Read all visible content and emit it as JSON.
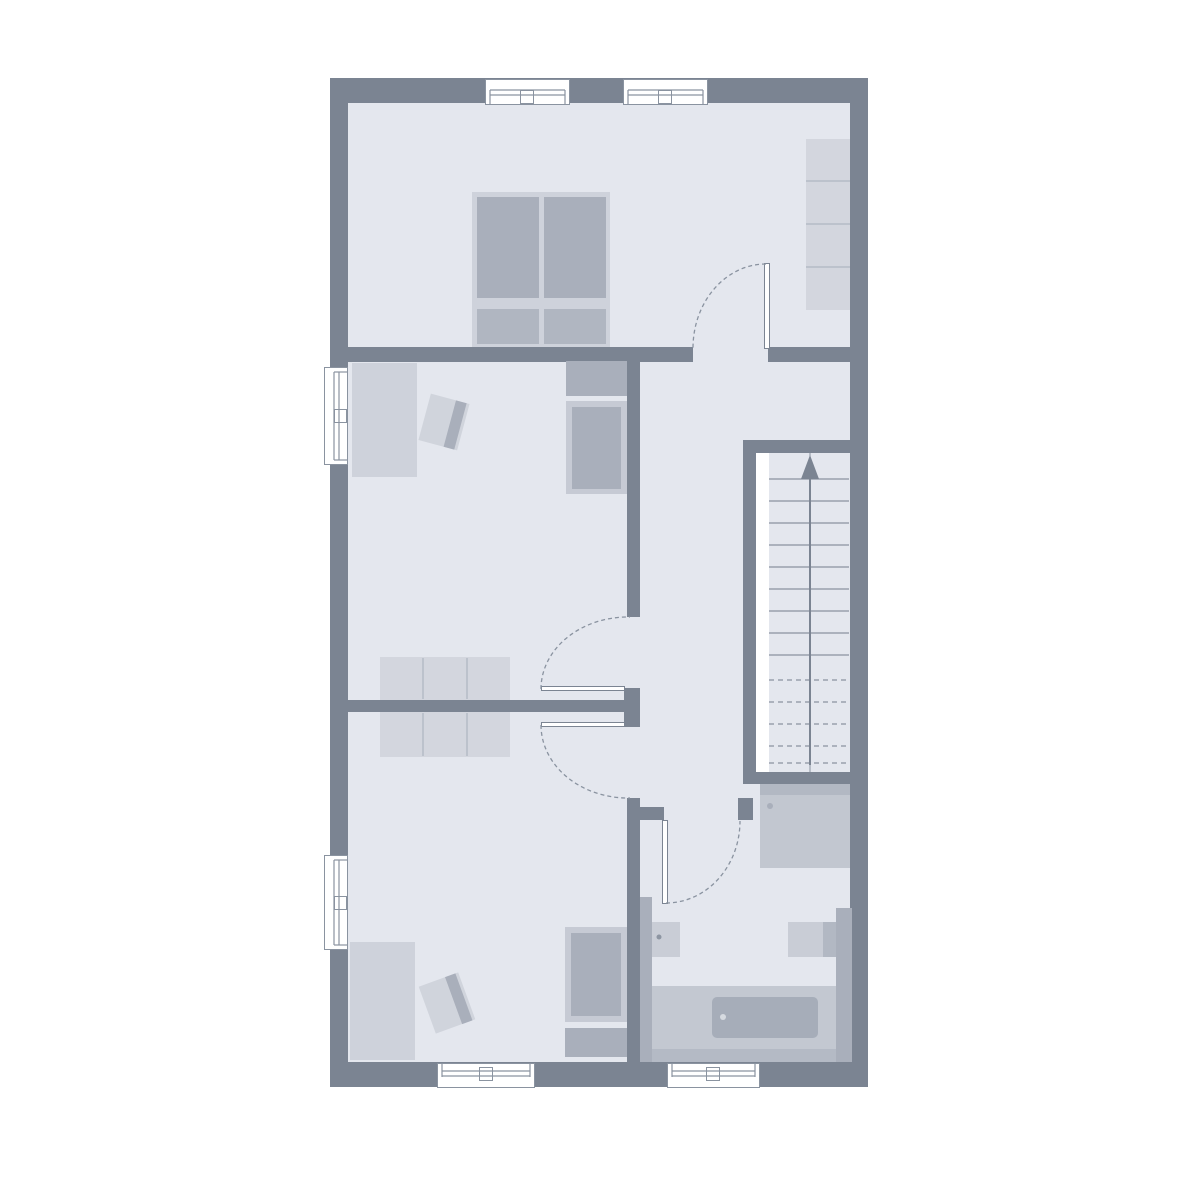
{
  "palette": {
    "bg": "#ffffff",
    "wall": "#7b8492",
    "floor": "#e4e7ee",
    "white": "#ffffff",
    "line": "#8a93a0",
    "furn_light": "#ced2db",
    "furn_light2": "#d3d6de",
    "furn_frame": "#c6cad4",
    "furn_med": "#a9afbb",
    "furn_med2": "#b2b8c3",
    "pillow": "#b0b6c1",
    "shower": "#c2c7d0",
    "basin": "#c9cdd6",
    "surround": "#c3c8d1",
    "tub": "#a6adb9",
    "band": "#b4bac5",
    "chair": "#d0d4dc",
    "divider": "#b5bbc6",
    "dot_light": "#d6dae0",
    "dot_dark": "#8d95a2"
  },
  "stairs": {
    "direction": "up",
    "solid_treads": 9,
    "dashed_treads": 5
  },
  "counts": {
    "windows": 6,
    "door_swings": 4,
    "rooms": 5
  },
  "plan": {
    "width": 1200,
    "height": 1200,
    "rects": [
      {
        "name": "outer-wall",
        "x": 330,
        "y": 78,
        "w": 538,
        "h": 1009,
        "fill": "wall"
      },
      {
        "name": "floor",
        "x": 348,
        "y": 103,
        "w": 502,
        "h": 959,
        "fill": "floor"
      },
      {
        "name": "wall-bedroom-bottom-left",
        "x": 348,
        "y": 347,
        "w": 345,
        "h": 15,
        "fill": "wall"
      },
      {
        "name": "wall-bedroom-bottom-right",
        "x": 768,
        "y": 347,
        "w": 82,
        "h": 15,
        "fill": "wall"
      },
      {
        "name": "wall-hallway-west",
        "x": 627,
        "y": 362,
        "w": 13,
        "h": 255,
        "fill": "wall"
      },
      {
        "name": "wall-center-door-jamb",
        "x": 624,
        "y": 688,
        "w": 16,
        "h": 39,
        "fill": "wall"
      },
      {
        "name": "wall-rooms-divider",
        "x": 348,
        "y": 700,
        "w": 276,
        "h": 12,
        "fill": "wall"
      },
      {
        "name": "wall-bathroom-west",
        "x": 627,
        "y": 798,
        "w": 13,
        "h": 264,
        "fill": "wall"
      },
      {
        "name": "wall-bathroom-door-jamb-left",
        "x": 627,
        "y": 807,
        "w": 37,
        "h": 13,
        "fill": "wall"
      },
      {
        "name": "wall-bathroom-door-jamb-right",
        "x": 738,
        "y": 798,
        "w": 15,
        "h": 22,
        "fill": "wall"
      },
      {
        "name": "wall-stairwell-top",
        "x": 743,
        "y": 440,
        "w": 107,
        "h": 13,
        "fill": "wall"
      },
      {
        "name": "wall-stairwell-left",
        "x": 743,
        "y": 453,
        "w": 13,
        "h": 329,
        "fill": "wall"
      },
      {
        "name": "wall-stairwell-bottom",
        "x": 743,
        "y": 772,
        "w": 107,
        "h": 12,
        "fill": "wall"
      },
      {
        "name": "stair-side-strip",
        "x": 756,
        "y": 453,
        "w": 13,
        "h": 319,
        "fill": "white"
      },
      {
        "name": "double-bed-frame",
        "x": 472,
        "y": 192,
        "w": 138,
        "h": 155,
        "fill": "furn_light"
      },
      {
        "name": "double-bed-mattress-left",
        "x": 477,
        "y": 197,
        "w": 62,
        "h": 101,
        "fill": "furn_med"
      },
      {
        "name": "double-bed-mattress-right",
        "x": 544,
        "y": 197,
        "w": 62,
        "h": 101,
        "fill": "furn_med"
      },
      {
        "name": "double-bed-pillow-left",
        "x": 477,
        "y": 309,
        "w": 62,
        "h": 35,
        "fill": "pillow"
      },
      {
        "name": "double-bed-pillow-right",
        "x": 544,
        "y": 309,
        "w": 62,
        "h": 35,
        "fill": "pillow"
      },
      {
        "name": "wardrobe-shelves",
        "x": 806,
        "y": 139,
        "w": 44,
        "h": 171,
        "fill": "furn_light2"
      },
      {
        "name": "desk-middle-room",
        "x": 352,
        "y": 363,
        "w": 65,
        "h": 114,
        "fill": "furn_light"
      },
      {
        "name": "single-bed-headboard-middle",
        "x": 566,
        "y": 361,
        "w": 61,
        "h": 35,
        "fill": "furn_med"
      },
      {
        "name": "single-bed-frame-middle",
        "x": 566,
        "y": 401,
        "w": 61,
        "h": 93,
        "fill": "furn_frame"
      },
      {
        "name": "single-bed-mattress-middle",
        "x": 572,
        "y": 407,
        "w": 49,
        "h": 82,
        "fill": "furn_med"
      },
      {
        "name": "dresser-middle-room",
        "x": 380,
        "y": 657,
        "w": 130,
        "h": 43,
        "fill": "furn_light2"
      },
      {
        "name": "dresser-bottom-room",
        "x": 380,
        "y": 712,
        "w": 130,
        "h": 45,
        "fill": "furn_light2"
      },
      {
        "name": "desk-bottom-room",
        "x": 350,
        "y": 942,
        "w": 65,
        "h": 118,
        "fill": "furn_light"
      },
      {
        "name": "single-bed-frame-bottom",
        "x": 565,
        "y": 927,
        "w": 62,
        "h": 95,
        "fill": "furn_frame"
      },
      {
        "name": "single-bed-mattress-bottom",
        "x": 571,
        "y": 933,
        "w": 50,
        "h": 83,
        "fill": "furn_med"
      },
      {
        "name": "single-bed-headboard-bottom",
        "x": 565,
        "y": 1028,
        "w": 62,
        "h": 29,
        "fill": "furn_med"
      },
      {
        "name": "chair-middle-room",
        "x": 424,
        "y": 398,
        "w": 40,
        "h": 48,
        "fill": "chair",
        "rotate": 15,
        "band": "furn_med"
      },
      {
        "name": "chair-bottom-room",
        "x": 426,
        "y": 978,
        "w": 42,
        "h": 50,
        "fill": "chair",
        "rotate": -20,
        "band": "furn_med"
      },
      {
        "name": "shower-top-band",
        "x": 760,
        "y": 784,
        "w": 90,
        "h": 11,
        "fill": "furn_med2"
      },
      {
        "name": "shower",
        "x": 760,
        "y": 795,
        "w": 90,
        "h": 73,
        "fill": "shower"
      },
      {
        "name": "bath-ledge-left",
        "x": 640,
        "y": 897,
        "w": 12,
        "h": 165,
        "fill": "furn_med"
      },
      {
        "name": "washbasin-left",
        "x": 652,
        "y": 922,
        "w": 28,
        "h": 35,
        "fill": "basin"
      },
      {
        "name": "washbasin-right",
        "x": 788,
        "y": 922,
        "w": 35,
        "h": 35,
        "fill": "basin"
      },
      {
        "name": "washbasin-right-side",
        "x": 823,
        "y": 922,
        "w": 13,
        "h": 35,
        "fill": "furn_med2"
      },
      {
        "name": "bath-pillar-right",
        "x": 836,
        "y": 908,
        "w": 16,
        "h": 154,
        "fill": "furn_med"
      },
      {
        "name": "bathtub-surround",
        "x": 652,
        "y": 986,
        "w": 184,
        "h": 76,
        "fill": "surround"
      },
      {
        "name": "bath-bottom-band",
        "x": 652,
        "y": 1049,
        "w": 184,
        "h": 13,
        "fill": "band"
      },
      {
        "name": "bathtub",
        "x": 712,
        "y": 997,
        "w": 106,
        "h": 41,
        "fill": "tub",
        "radius": 5
      },
      {
        "name": "window-top-1",
        "x": 485,
        "y": 79,
        "w": 85,
        "h": 26,
        "fill": "white",
        "stroke": "line"
      },
      {
        "name": "window-top-2",
        "x": 623,
        "y": 79,
        "w": 85,
        "h": 26,
        "fill": "white",
        "stroke": "line"
      },
      {
        "name": "window-left-1",
        "x": 324,
        "y": 367,
        "w": 24,
        "h": 98,
        "fill": "white",
        "stroke": "line"
      },
      {
        "name": "window-left-2",
        "x": 324,
        "y": 855,
        "w": 24,
        "h": 95,
        "fill": "white",
        "stroke": "line"
      },
      {
        "name": "window-bottom-1",
        "x": 437,
        "y": 1063,
        "w": 98,
        "h": 25,
        "fill": "white",
        "stroke": "line"
      },
      {
        "name": "window-bottom-2",
        "x": 667,
        "y": 1063,
        "w": 93,
        "h": 25,
        "fill": "white",
        "stroke": "line"
      },
      {
        "name": "window-top-1-pane",
        "x": 520,
        "y": 90,
        "w": 14,
        "h": 14,
        "fill": "white",
        "stroke": "line"
      },
      {
        "name": "window-top-2-pane",
        "x": 658,
        "y": 90,
        "w": 14,
        "h": 14,
        "fill": "white",
        "stroke": "line"
      },
      {
        "name": "window-left-1-pane",
        "x": 334,
        "y": 409,
        "w": 13,
        "h": 14,
        "fill": "white",
        "stroke": "line"
      },
      {
        "name": "window-left-2-pane",
        "x": 334,
        "y": 896,
        "w": 13,
        "h": 14,
        "fill": "white",
        "stroke": "line"
      },
      {
        "name": "window-bottom-1-pane",
        "x": 479,
        "y": 1067,
        "w": 14,
        "h": 14,
        "fill": "white",
        "stroke": "line"
      },
      {
        "name": "window-bottom-2-pane",
        "x": 706,
        "y": 1067,
        "w": 14,
        "h": 14,
        "fill": "white",
        "stroke": "line"
      },
      {
        "name": "door-leaf-bedroom",
        "x": 764,
        "y": 263,
        "w": 6,
        "h": 86,
        "fill": "white",
        "stroke": "wall"
      },
      {
        "name": "door-leaf-middle-room",
        "x": 541,
        "y": 686,
        "w": 84,
        "h": 5,
        "fill": "white",
        "stroke": "wall"
      },
      {
        "name": "door-leaf-bottom-room",
        "x": 541,
        "y": 722,
        "w": 84,
        "h": 5,
        "fill": "white",
        "stroke": "wall"
      },
      {
        "name": "door-leaf-bathroom",
        "x": 662,
        "y": 820,
        "w": 6,
        "h": 84,
        "fill": "white",
        "stroke": "wall"
      }
    ],
    "svg": {
      "lines": [
        {
          "name": "window-glyph",
          "x1": 490,
          "y1": 90,
          "x2": 565,
          "y2": 90
        },
        {
          "name": "window-glyph",
          "x1": 490,
          "y1": 95,
          "x2": 565,
          "y2": 95
        },
        {
          "name": "window-glyph",
          "x1": 490,
          "y1": 90,
          "x2": 490,
          "y2": 104
        },
        {
          "name": "window-glyph",
          "x1": 565,
          "y1": 90,
          "x2": 565,
          "y2": 104
        },
        {
          "name": "window-glyph",
          "x1": 628,
          "y1": 90,
          "x2": 703,
          "y2": 90
        },
        {
          "name": "window-glyph",
          "x1": 628,
          "y1": 95,
          "x2": 703,
          "y2": 95
        },
        {
          "name": "window-glyph",
          "x1": 628,
          "y1": 90,
          "x2": 628,
          "y2": 104
        },
        {
          "name": "window-glyph",
          "x1": 703,
          "y1": 90,
          "x2": 703,
          "y2": 104
        },
        {
          "name": "window-glyph",
          "x1": 334,
          "y1": 372,
          "x2": 334,
          "y2": 460
        },
        {
          "name": "window-glyph",
          "x1": 339,
          "y1": 372,
          "x2": 339,
          "y2": 460
        },
        {
          "name": "window-glyph",
          "x1": 334,
          "y1": 372,
          "x2": 347,
          "y2": 372
        },
        {
          "name": "window-glyph",
          "x1": 334,
          "y1": 460,
          "x2": 347,
          "y2": 460
        },
        {
          "name": "window-glyph",
          "x1": 334,
          "y1": 860,
          "x2": 334,
          "y2": 945
        },
        {
          "name": "window-glyph",
          "x1": 339,
          "y1": 860,
          "x2": 339,
          "y2": 945
        },
        {
          "name": "window-glyph",
          "x1": 334,
          "y1": 860,
          "x2": 347,
          "y2": 860
        },
        {
          "name": "window-glyph",
          "x1": 334,
          "y1": 945,
          "x2": 347,
          "y2": 945
        },
        {
          "name": "window-glyph",
          "x1": 442,
          "y1": 1071,
          "x2": 530,
          "y2": 1071
        },
        {
          "name": "window-glyph",
          "x1": 442,
          "y1": 1076,
          "x2": 530,
          "y2": 1076
        },
        {
          "name": "window-glyph",
          "x1": 442,
          "y1": 1064,
          "x2": 442,
          "y2": 1077
        },
        {
          "name": "window-glyph",
          "x1": 530,
          "y1": 1064,
          "x2": 530,
          "y2": 1077
        },
        {
          "name": "window-glyph",
          "x1": 672,
          "y1": 1071,
          "x2": 755,
          "y2": 1071
        },
        {
          "name": "window-glyph",
          "x1": 672,
          "y1": 1076,
          "x2": 755,
          "y2": 1076
        },
        {
          "name": "window-glyph",
          "x1": 672,
          "y1": 1064,
          "x2": 672,
          "y2": 1077
        },
        {
          "name": "window-glyph",
          "x1": 755,
          "y1": 1064,
          "x2": 755,
          "y2": 1077
        },
        {
          "name": "wardrobe-divider",
          "x1": 806,
          "y1": 181,
          "x2": 850,
          "y2": 181,
          "c": "divider",
          "w": 1.5
        },
        {
          "name": "wardrobe-divider",
          "x1": 806,
          "y1": 224,
          "x2": 850,
          "y2": 224,
          "c": "divider",
          "w": 1.5
        },
        {
          "name": "wardrobe-divider",
          "x1": 806,
          "y1": 267,
          "x2": 850,
          "y2": 267,
          "c": "divider",
          "w": 1.5
        },
        {
          "name": "dresser-divider",
          "x1": 423,
          "y1": 658,
          "x2": 423,
          "y2": 699,
          "c": "divider",
          "w": 1.5
        },
        {
          "name": "dresser-divider",
          "x1": 467,
          "y1": 658,
          "x2": 467,
          "y2": 699,
          "c": "divider",
          "w": 1.5
        },
        {
          "name": "dresser-divider",
          "x1": 423,
          "y1": 713,
          "x2": 423,
          "y2": 756,
          "c": "divider",
          "w": 1.5
        },
        {
          "name": "dresser-divider",
          "x1": 467,
          "y1": 713,
          "x2": 467,
          "y2": 756,
          "c": "divider",
          "w": 1.5
        },
        {
          "name": "stair-tread",
          "x1": 769,
          "y1": 479,
          "x2": 849,
          "y2": 479
        },
        {
          "name": "stair-tread",
          "x1": 769,
          "y1": 501,
          "x2": 849,
          "y2": 501
        },
        {
          "name": "stair-tread",
          "x1": 769,
          "y1": 523,
          "x2": 849,
          "y2": 523
        },
        {
          "name": "stair-tread",
          "x1": 769,
          "y1": 545,
          "x2": 849,
          "y2": 545
        },
        {
          "name": "stair-tread",
          "x1": 769,
          "y1": 567,
          "x2": 849,
          "y2": 567
        },
        {
          "name": "stair-tread",
          "x1": 769,
          "y1": 589,
          "x2": 849,
          "y2": 589
        },
        {
          "name": "stair-tread",
          "x1": 769,
          "y1": 611,
          "x2": 849,
          "y2": 611
        },
        {
          "name": "stair-tread",
          "x1": 769,
          "y1": 633,
          "x2": 849,
          "y2": 633
        },
        {
          "name": "stair-tread",
          "x1": 769,
          "y1": 655,
          "x2": 849,
          "y2": 655
        },
        {
          "name": "stair-tread-dashed",
          "x1": 769,
          "y1": 680,
          "x2": 849,
          "y2": 680,
          "dash": "5,4"
        },
        {
          "name": "stair-tread-dashed",
          "x1": 769,
          "y1": 702,
          "x2": 849,
          "y2": 702,
          "dash": "5,4"
        },
        {
          "name": "stair-tread-dashed",
          "x1": 769,
          "y1": 724,
          "x2": 849,
          "y2": 724,
          "dash": "5,4"
        },
        {
          "name": "stair-tread-dashed",
          "x1": 769,
          "y1": 746,
          "x2": 849,
          "y2": 746,
          "dash": "5,4"
        },
        {
          "name": "stair-tread-dashed",
          "x1": 769,
          "y1": 763,
          "x2": 849,
          "y2": 763,
          "dash": "5,4"
        },
        {
          "name": "stair-center-line",
          "x1": 810,
          "y1": 453,
          "x2": 810,
          "y2": 772,
          "w": 1
        },
        {
          "name": "stair-arrow-shaft",
          "x1": 810,
          "y1": 765,
          "x2": 810,
          "y2": 476,
          "c": "wall",
          "w": 2
        }
      ],
      "paths": [
        {
          "name": "door-arc-bedroom",
          "d": "M 766 264 A 73 84 0 0 0 693 348",
          "dash": "4,3"
        },
        {
          "name": "door-arc-middle-room",
          "d": "M 541 689 A 87 72 0 0 1 630 617",
          "dash": "4,3"
        },
        {
          "name": "door-arc-bottom-room",
          "d": "M 541 725 A 87 73 0 0 0 630 798",
          "dash": "4,3"
        },
        {
          "name": "door-arc-bathroom",
          "d": "M 666 903 A 74 82 0 0 0 740 821",
          "dash": "4,3"
        }
      ],
      "circles": [
        {
          "name": "shower-drain-dot",
          "cx": 770,
          "cy": 806,
          "r": 3,
          "c": "furn_med"
        },
        {
          "name": "washbasin-drain-dot",
          "cx": 659,
          "cy": 937,
          "r": 2.5,
          "c": "dot_dark"
        },
        {
          "name": "bathtub-drain-dot",
          "cx": 723,
          "cy": 1017,
          "r": 3,
          "c": "dot_light"
        }
      ],
      "polygons": [
        {
          "name": "stair-arrow-head",
          "points": "810,455 801,479 819,479",
          "c": "wall"
        }
      ]
    }
  }
}
